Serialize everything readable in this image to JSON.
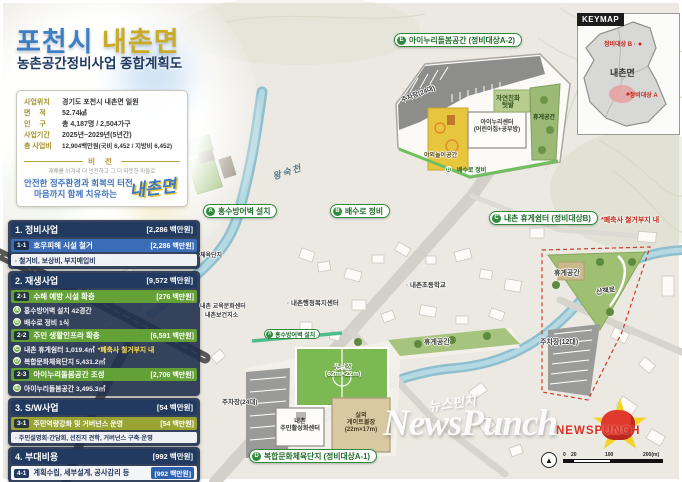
{
  "header": {
    "title_city": "포천시",
    "title_myeon": "내촌면",
    "subtitle": "농촌공간정비사업 종합계획도"
  },
  "info_box": {
    "rows": [
      {
        "label": "사업위치",
        "value": "경기도 포천시 내촌면 일원"
      },
      {
        "label": "면　 적",
        "value": "52.74㎢"
      },
      {
        "label": "인　 구",
        "value": "총 4,187명 / 2,504가구"
      },
      {
        "label": "사업기간",
        "value": "2025년~2029년(5년간)"
      },
      {
        "label": "총 사업비",
        "value": "12,904백만원(국비 6,452 / 지방비 6,452)"
      }
    ],
    "vision_title": "비 전",
    "vision_tagline": "재해를 이겨내 더 안전하고 그 더 따뜻한 마을로",
    "vision_line1": "안전한 정주환경과 회복의 터전,",
    "vision_line2": "마음까지 함께 치유하는",
    "vision_brand": "내촌면"
  },
  "plan_list": {
    "sections": [
      {
        "title": "1. 정비사업",
        "amount": "[2,286 백만원]"
      },
      {
        "title": "2. 재생사업",
        "amount": "[9,572 백만원]"
      },
      {
        "title": "3. S/W사업",
        "amount": "[54 백만원]"
      },
      {
        "title": "4. 부대비용",
        "amount": "[992 백만원]"
      }
    ],
    "items": [
      {
        "badge": "1-1",
        "label": "호우피해 시설 철거",
        "amount": "[2,286 백만원]"
      },
      {
        "badge": "2-1",
        "label": "수해 예방 시설 확충",
        "amount": "[276 백만원]"
      },
      {
        "badge": "2-2",
        "label": "주민 생활인프라 확충",
        "amount": "[6,591 백만원]"
      },
      {
        "badge": "2-3",
        "label": "아이누리돌봄공간 조성",
        "amount": "[2,706 백만원]"
      },
      {
        "badge": "3-1",
        "label": "주민역량강화 및 거버넌스 운영",
        "amount": "[54 백만원]"
      },
      {
        "badge": "4-1",
        "label": "계획수립, 세부설계, 공사감리 등",
        "amount": "[992 백만원]"
      }
    ],
    "notes": {
      "s1": "· 철거비, 보상비, 부지매입비",
      "s3": "· 주민설명회·간담회, 선진지 견학, 거버넌스 구축·운영"
    },
    "details": [
      {
        "letter": "A",
        "text": "홍수방어벽 설치 42경간"
      },
      {
        "letter": "B",
        "text": "배수로 정비 1식"
      },
      {
        "letter": "C",
        "text": "내촌 휴게쉼터 1,019.4㎡",
        "note": "*폐축사 철거부지 내"
      },
      {
        "letter": "D",
        "text": "복합문화체육단지 5,431.2㎡"
      },
      {
        "letter": "E",
        "text": "아이누리돌봄공간 3,495.3㎡"
      }
    ]
  },
  "map": {
    "pills": [
      {
        "letter": "A",
        "text": "홍수방어벽 설치"
      },
      {
        "letter": "B",
        "text": "배수로 정비"
      },
      {
        "letter": "C",
        "text": "내촌 휴게쉼터 (정비대상B)",
        "note": "*폐축사 철거부지 내"
      },
      {
        "letter": "D",
        "text": "복합문화체육단지 (정비대상A-1)"
      },
      {
        "letter": "E",
        "text": "아이누리돌봄공간 (정비대상A-2)"
      }
    ],
    "labels": {
      "river": "왕숙천",
      "sports": "체육단지",
      "edu_center": "내촌 교육문화센터",
      "health": "내촌보건지소",
      "school": "· 내촌초등학교",
      "welfare": "· 내촌행정복지센터"
    },
    "childcare_inset": {
      "parking": "주차장(24대)",
      "garden": "자연친화\n텃밭",
      "center": "아이누리센터\n(어린이집+공부방)",
      "play": "야외놀이공간",
      "rest": "휴게공간",
      "drain_letter": "B",
      "drain": "배수로 정비"
    },
    "rest_inset": {
      "rest": "휴게공간",
      "trail": "산책로",
      "parking": "주차장(12대)"
    },
    "sports_inset": {
      "wall_letter": "A",
      "wall": "홍수방어벽 설치",
      "futsal": "풋살장\n(62m×22m)",
      "rest": "휴게공간",
      "parking": "주차장(24대)",
      "center": "내촌\n주민활성화센터",
      "gateball": "실외\n게이트볼장\n(22m×17m)"
    }
  },
  "keymap": {
    "title": "KEYMAP",
    "myeon": "내촌면",
    "target_b": "정비대상 B ·",
    "target_a": "· 정비대상 A"
  },
  "scalebar": {
    "t0": "0",
    "t20": "20",
    "t100": "100",
    "t200": "200(m)"
  },
  "watermark": {
    "script": "뉴스펀치",
    "main": "NewsPunch",
    "sub": "NEWSPUNCH"
  },
  "colors": {
    "title_blue": "#3d7fc4",
    "title_gold": "#c9ab25",
    "navy": "#223a5f",
    "bar_blue": "#3a6db8",
    "bar_green": "#63a036",
    "bar_olive": "#99a433",
    "pill_green": "#2f8a3c",
    "note_yellow": "#ffe34d",
    "alert_red": "#c4281b",
    "river_blue": "#8fbfcf"
  }
}
